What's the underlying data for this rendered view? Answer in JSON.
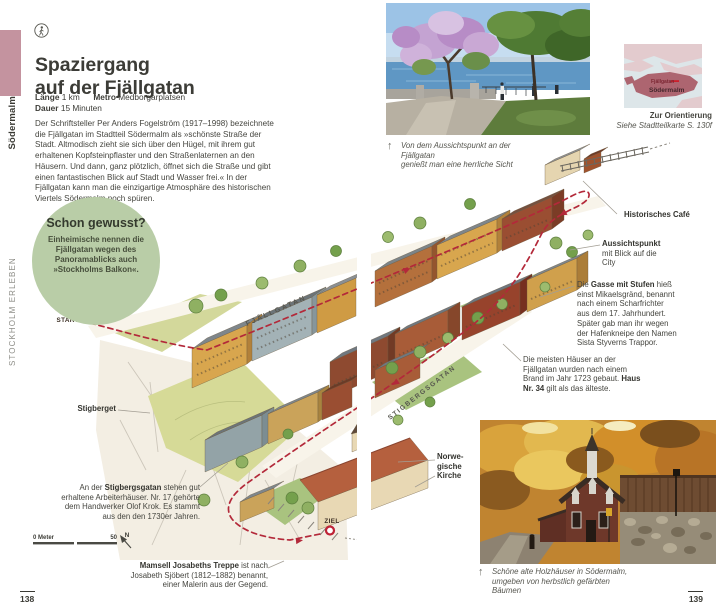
{
  "sidebar": {
    "series": "STOCKHOLM ERLEBEN",
    "chapter": "Södermalm"
  },
  "header": {
    "title_line1": "Spaziergang",
    "title_line2": "auf der Fjällgatan",
    "length_label": "Länge",
    "length_value": "1 km",
    "metro_label": "Metro",
    "metro_value": "Medborgarplatsen",
    "duration_label": "Dauer",
    "duration_value": "15 Minuten"
  },
  "intro": "Der Schriftsteller Per Anders Fogelström (1917–1998) bezeichnete die Fjällgatan im Stadtteil Södermalm als »schönste Straße der Stadt. Altmodisch zieht sie sich über den Hügel, mit ihrem gut erhaltenen Kopfsteinpflaster und den Straßenlaternen an den Häusern. Und dann, ganz plötzlich, öffnet sich die Straße und gibt einen fantastischen Blick auf Stadt und Wasser frei.« In der Fjällgatan kann man die einzigartige Atmosphäre des historischen Viertels Södermalm noch spüren.",
  "factbox": {
    "title": "Schon gewusst?",
    "body": "Einheimische nennen die Fjällgatan wegen des Panoramablicks auch »Stockholms Balkon«."
  },
  "photo_top": {
    "caption_line1": "Von dem Aussichtspunkt an der Fjällgatan",
    "caption_line2": "genießt man eine herrliche Sicht"
  },
  "locator": {
    "street": "Fjällgatan",
    "district": "Södermalm",
    "caption_title": "Zur Orientierung",
    "caption_ref": "Siehe Stadtteilkarte S. 130f"
  },
  "map": {
    "start": "START",
    "ziel": "ZIEL",
    "street_fjallgatan": "FJÄLLGATAN",
    "street_stigbergsgatan": "STIGBERGSGATAN",
    "scale_start": "0 Meter",
    "scale_end": "50",
    "compass": "N"
  },
  "annotations": {
    "cafe": "Historisches Café",
    "viewpoint_bold": "Aussichtspunkt",
    "viewpoint_rest": " mit Blick auf die City",
    "alley_pre": "Die ",
    "alley_bold": "Gasse mit Stufen",
    "alley_rest": " hieß einst Mikaelsgränd, benannt nach einem Scharfrichter aus dem 17. Jahrhundert. Später gab man ihr wegen der Hafenkneipe den Namen Sista Styverns Trappor.",
    "houses_pre": "Die meisten Häuser an der Fjällgatan wurden nach einem Brand im Jahr 1723 gebaut. ",
    "houses_bold": "Haus Nr. 34",
    "houses_rest": " gilt als das älteste.",
    "stigberget": "Stigberget",
    "workers_pre": "An der ",
    "workers_bold": "Stigbergsgatan",
    "workers_rest": " stehen gut erhaltene Arbeiterhäuser. Nr. 17 gehörte dem Handwerker Olof Krok. Es stammt aus den den 1730er Jahren.",
    "church_line1": "Norwe-",
    "church_line2": "gische",
    "church_line3": "Kirche",
    "stairs_bold": "Mamsell Josabeths Treppe",
    "stairs_rest": " ist nach Josabeth Sjöbert (1812–1882) benannt, einer Malerin aus der Gegend."
  },
  "photo_bottom": {
    "caption_line1": "Schöne alte Holzhäuser in Södermalm,",
    "caption_line2": "umgeben von herbstlich gefärbten Bäumen"
  },
  "pages": {
    "left": "138",
    "right": "139"
  },
  "colors": {
    "accent_red": "#b3293a",
    "sidebar_pink": "#c4939f",
    "factbox_green": "#b9cda7",
    "locator_island": "#ad6570",
    "map_lawn": "#d6da97"
  }
}
